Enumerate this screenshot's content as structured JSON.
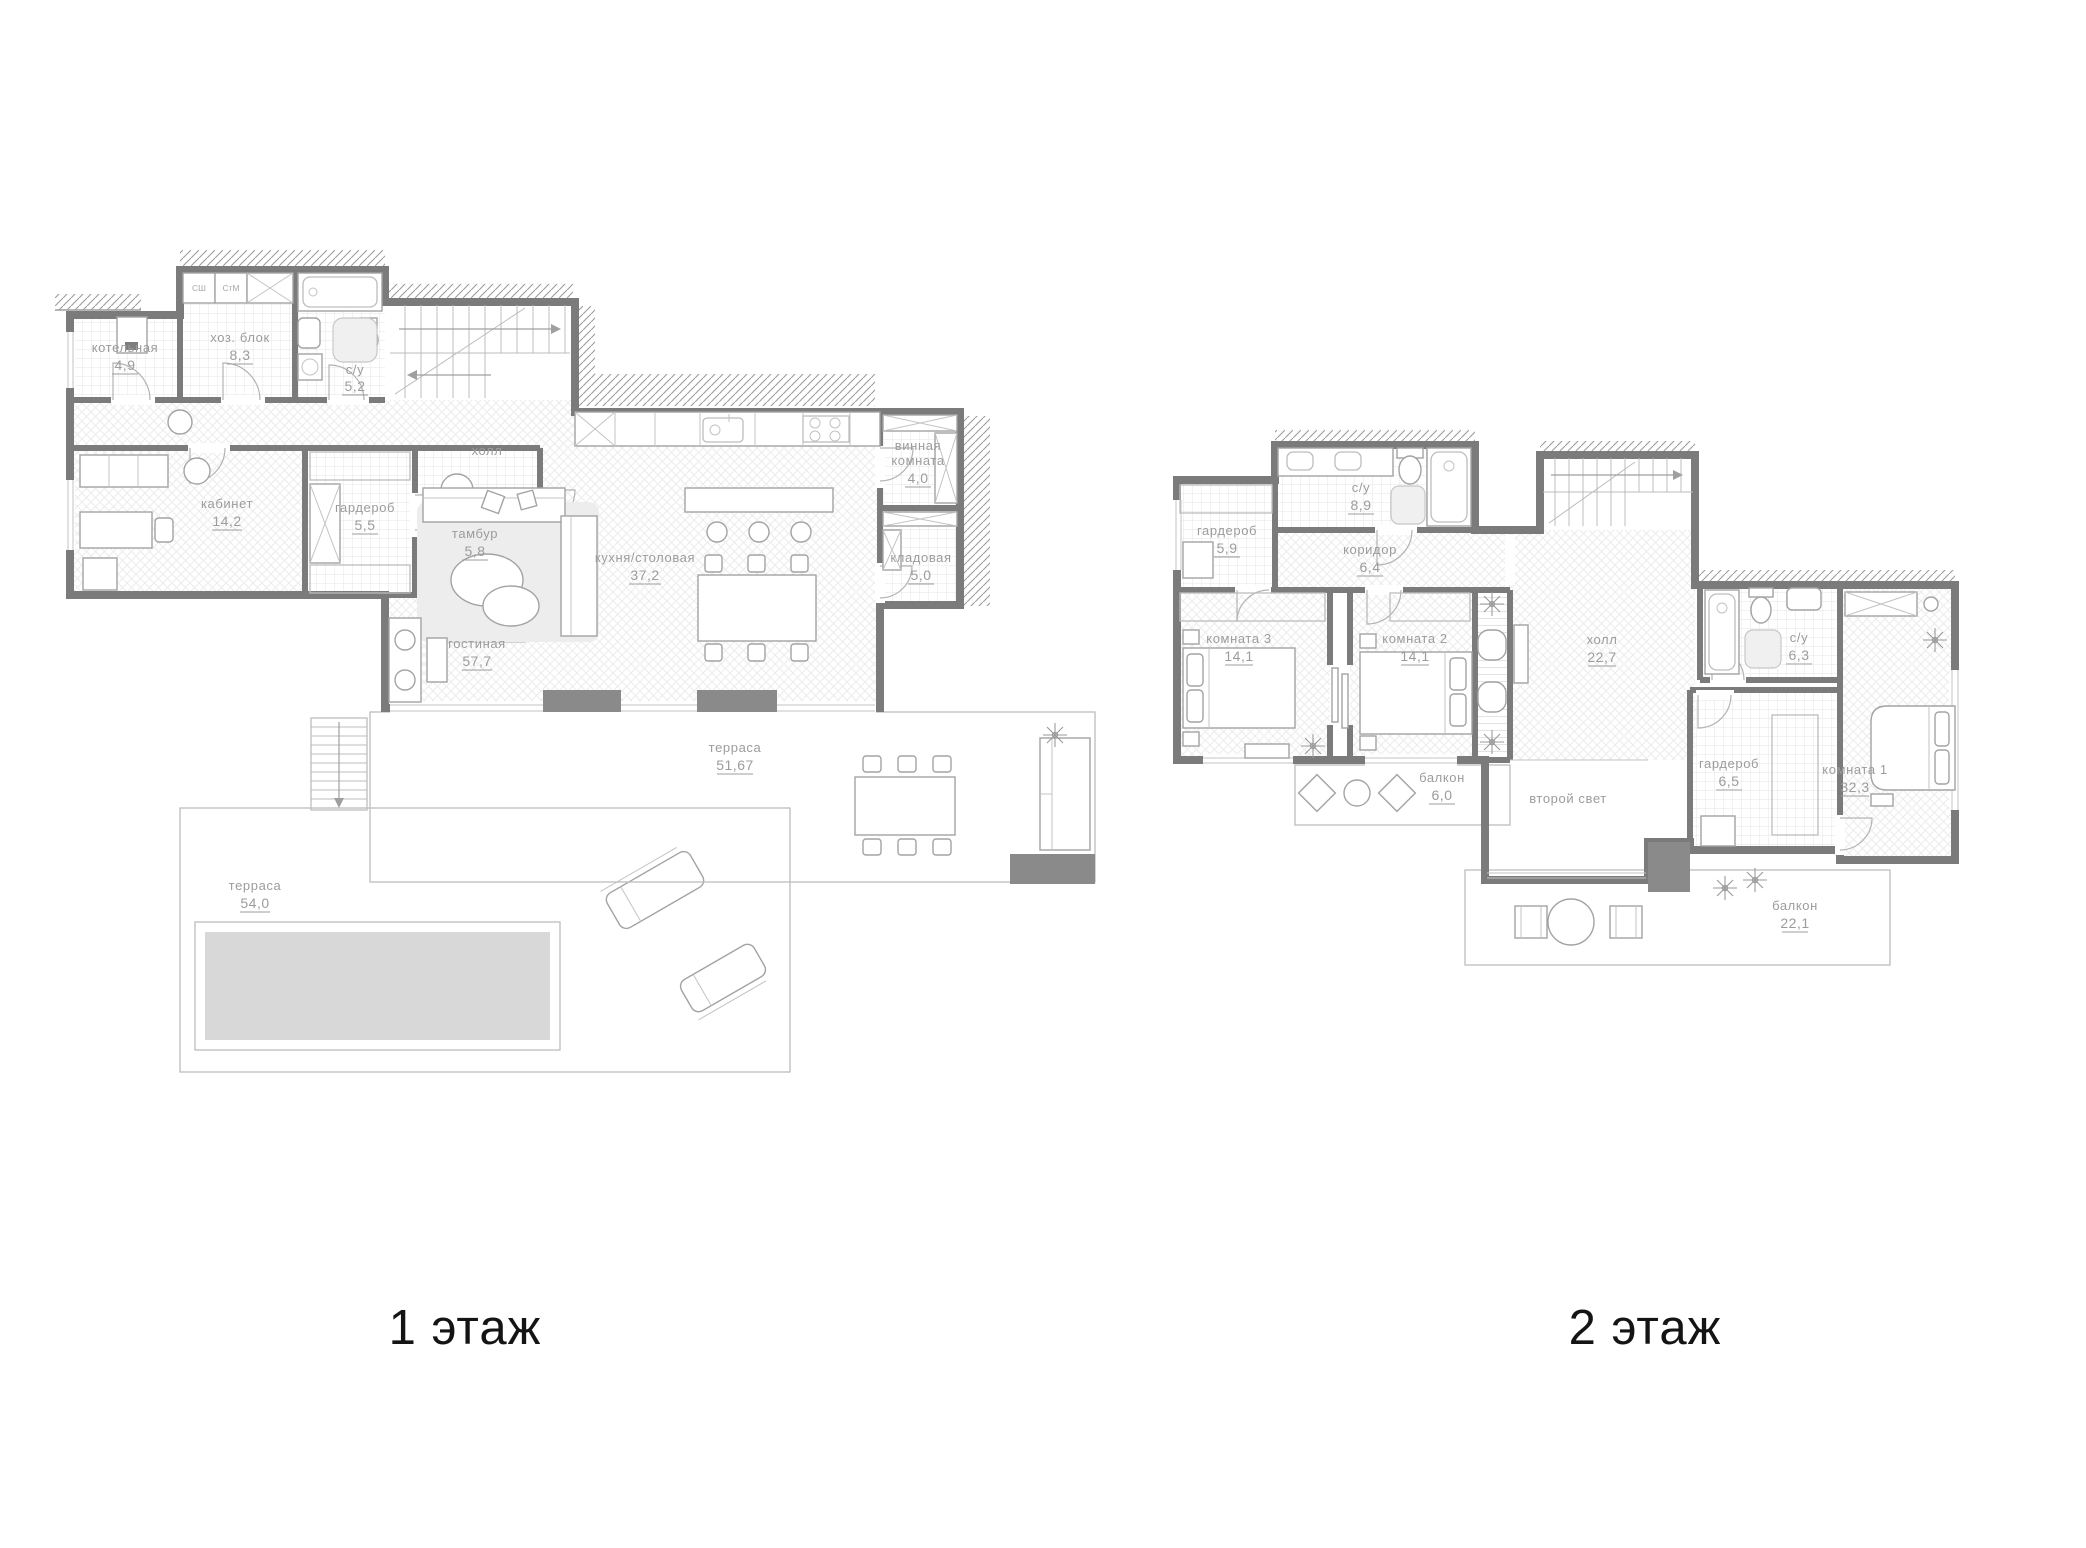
{
  "captions": {
    "floor1": "1 этаж",
    "floor2": "2 этаж"
  },
  "colors": {
    "wall": "#7b7b7b",
    "label": "#9c9c9c",
    "caption": "#141414",
    "pool": "#d8d8d8"
  },
  "floor1": {
    "closets": {
      "sh": "СШ",
      "stm": "СтМ"
    },
    "rooms": [
      {
        "name": "котельная",
        "area": "4,9"
      },
      {
        "name": "хоз. блок",
        "area": "8,3"
      },
      {
        "name": "с/у",
        "area": "5,2"
      },
      {
        "name": "кабинет",
        "area": "14,2"
      },
      {
        "name": "гардероб",
        "area": "5,5"
      },
      {
        "name": "тамбур",
        "area": "5,8"
      },
      {
        "name": "холл",
        "area": ""
      },
      {
        "name": "кухня/столовая",
        "area": "37,2"
      },
      {
        "line1": "винная",
        "line2": "комната",
        "area": "4,0"
      },
      {
        "name": "кладовая",
        "area": "5,0"
      },
      {
        "name": "гостиная",
        "area": "57,7"
      },
      {
        "name": "терраса",
        "area": "51,67"
      },
      {
        "name": "терраса",
        "area": "54,0"
      }
    ]
  },
  "floor2": {
    "rooms": [
      {
        "name": "гардероб",
        "area": "5,9"
      },
      {
        "name": "с/у",
        "area": "8,9"
      },
      {
        "name": "коридор",
        "area": "6,4"
      },
      {
        "name": "комната 3",
        "area": "14,1"
      },
      {
        "name": "комната 2",
        "area": "14,1"
      },
      {
        "name": "холл",
        "area": "22,7"
      },
      {
        "name": "с/у",
        "area": "6,3"
      },
      {
        "name": "гардероб",
        "area": "6,5"
      },
      {
        "name": "комната 1",
        "area": "32,3"
      },
      {
        "name": "балкон",
        "area": "6,0"
      },
      {
        "name": "второй свет",
        "area": ""
      },
      {
        "name": "балкон",
        "area": "22,1"
      }
    ]
  }
}
